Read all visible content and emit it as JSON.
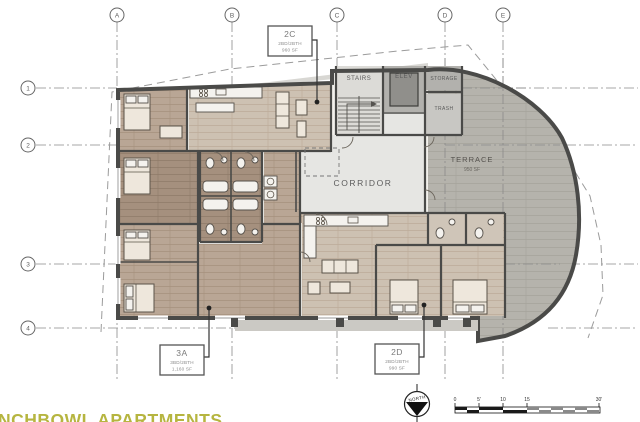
{
  "drawing": {
    "project_name_partial": "NCHBOWL APARTMENTS"
  },
  "grid": {
    "columns": [
      "A",
      "B",
      "C",
      "D",
      "E"
    ],
    "rows": [
      "1",
      "2",
      "3",
      "4"
    ]
  },
  "core_rooms": {
    "stairs": "STAIRS",
    "elevator": "ELEV",
    "storage": "STORAGE",
    "trash": "TRASH",
    "corridor": "CORRIDOR",
    "terrace_name": "TERRACE",
    "terrace_area": "950 SF"
  },
  "units": [
    {
      "id": "2C",
      "config": "2BD/2BTH",
      "area": "960 SF"
    },
    {
      "id": "3A",
      "config": "3BD/2BTH",
      "area": "1,160 SF"
    },
    {
      "id": "2D",
      "config": "2BD/2BTH",
      "area": "990 SF"
    }
  ],
  "north_arrow_label": "NORTH",
  "scale_bar": {
    "tick_labels": [
      "0",
      "5'",
      "10",
      "15",
      "30'"
    ]
  },
  "colors": {
    "walls": "#4a4a48",
    "unit_floor_light": "#cdc1b2",
    "unit_floor_medium": "#b9a695",
    "unit_floor_dark": "#a5907e",
    "terrace_floor": "#b5b3ac",
    "corridor_floor": "#e6e6e3",
    "title_text": "#b6b540"
  }
}
